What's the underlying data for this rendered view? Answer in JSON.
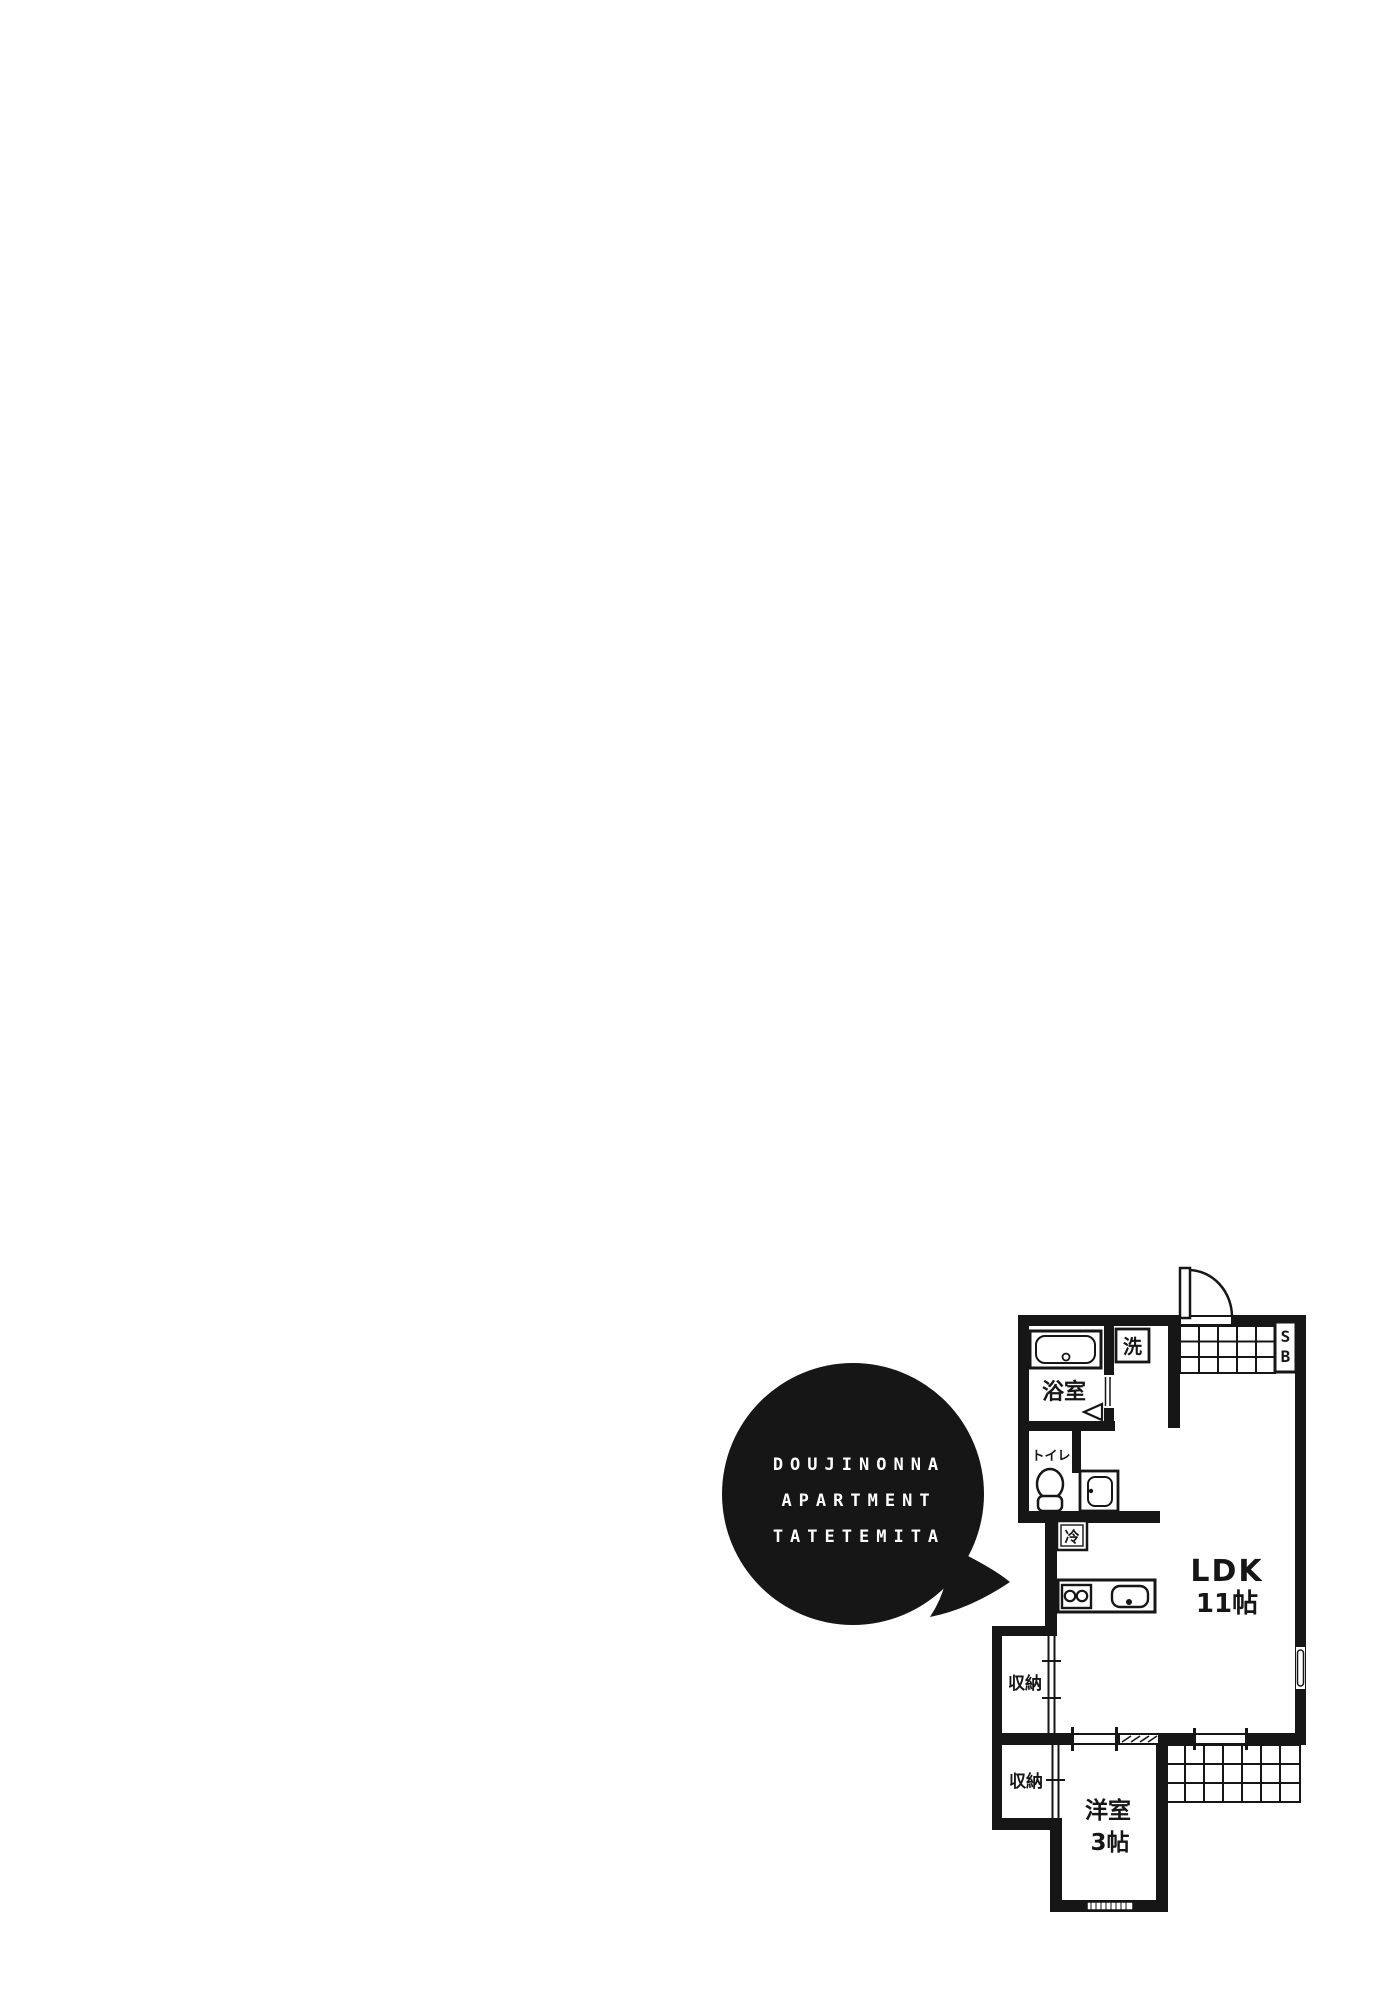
{
  "page": {
    "background": "#ffffff",
    "ink": "#161616"
  },
  "speech_bubble": {
    "lines": [
      "DOUJINONNA",
      "APARTMENT",
      "TATETEMITA"
    ],
    "fill": "#161616",
    "text_color": "#ffffff"
  },
  "floor_plan": {
    "labels": {
      "bath": "浴室",
      "washer": "洗",
      "toilet": "トイレ",
      "fridge": "冷",
      "shoe_box_top": "S",
      "shoe_box_bottom": "B",
      "ldk_name": "LDK",
      "ldk_size": "11帖",
      "closet_upper": "収納",
      "closet_lower": "収納",
      "western_name": "洋室",
      "western_size": "3帖"
    }
  }
}
